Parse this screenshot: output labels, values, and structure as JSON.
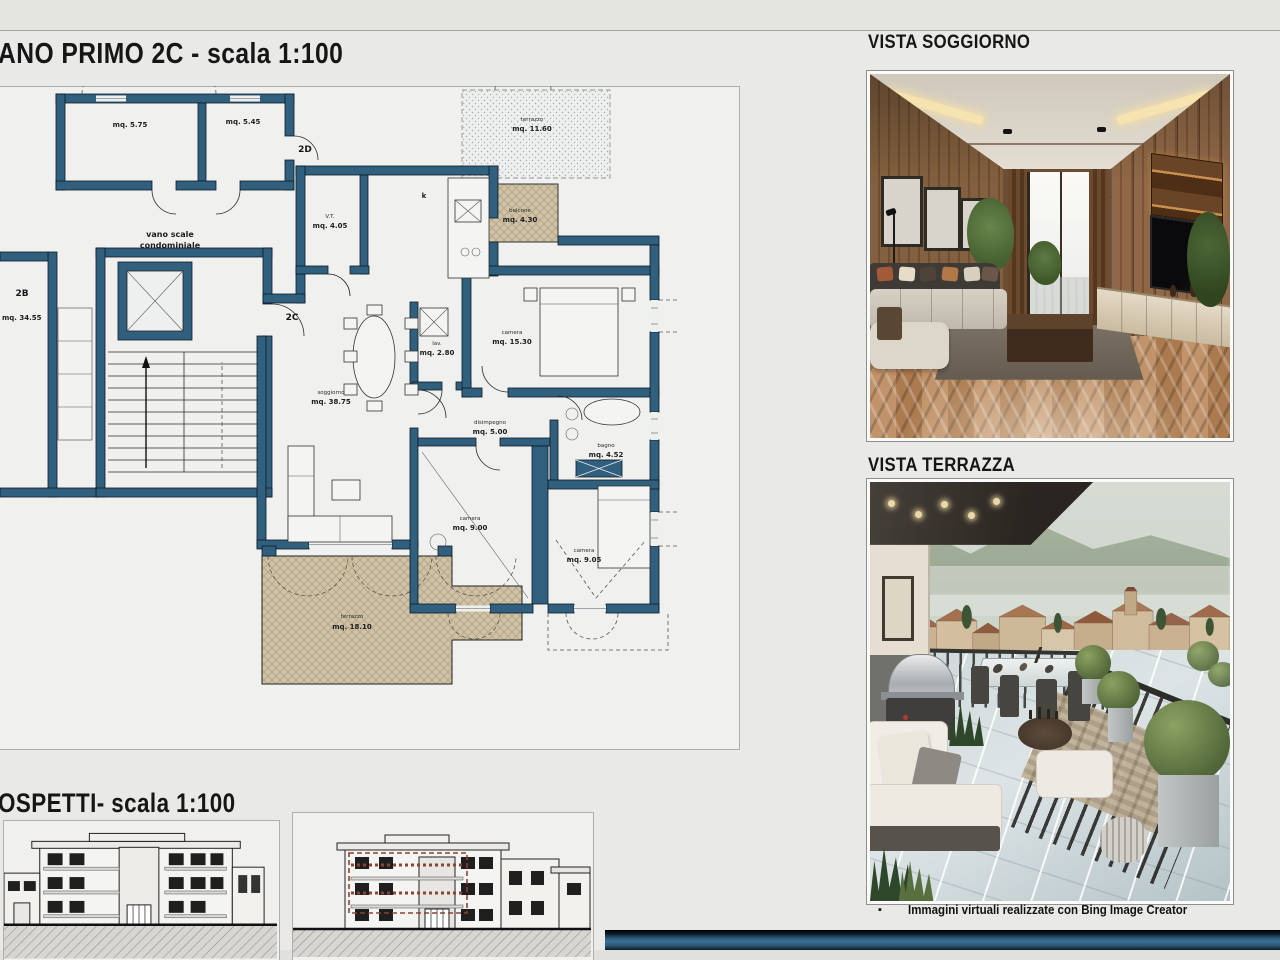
{
  "header": {
    "plan_title": "ANO PRIMO 2C - scala 1:100",
    "elevations_title": "OSPETTI- scala 1:100"
  },
  "views": {
    "soggiorno_title": "VISTA SOGGIORNO",
    "terrazza_title": "VISTA TERRAZZA",
    "credit_bullet": "▪",
    "credit_text": "Immagini virtuali realizzate con Bing Image Creator"
  },
  "plan": {
    "units": {
      "b": "2B",
      "c": "2C",
      "d": "2D"
    },
    "stair_line1": "vano scale",
    "stair_line2": "condominiale",
    "kitchen_label": "k",
    "rooms": [
      {
        "name": "",
        "area": "mq. 5.75"
      },
      {
        "name": "",
        "area": "mq. 5.45"
      },
      {
        "name": "V.T.",
        "area": "mq. 4.05"
      },
      {
        "name": "terrazzo",
        "area": "mq. 11.60"
      },
      {
        "name": "balcone",
        "area": "mq. 4.30"
      },
      {
        "name": "soggiorno",
        "area": "mq. 38.75"
      },
      {
        "name": "lav.",
        "area": "mq. 2.80"
      },
      {
        "name": "camera",
        "area": "mq. 15.30"
      },
      {
        "name": "disimpegno",
        "area": "mq. 5.00"
      },
      {
        "name": "bagno",
        "area": "mq. 4.52"
      },
      {
        "name": "camera",
        "area": "mq. 9.00"
      },
      {
        "name": "camera",
        "area": "mq. 9.05"
      },
      {
        "name": "terrazzo",
        "area": "mq. 18.10"
      },
      {
        "name": "",
        "area": "mq. 34.55"
      }
    ]
  },
  "colors": {
    "wall_blue": "#31607F",
    "terrace_tan": "#CFC2A6",
    "bottom_bar_blue": "#2F6183"
  }
}
